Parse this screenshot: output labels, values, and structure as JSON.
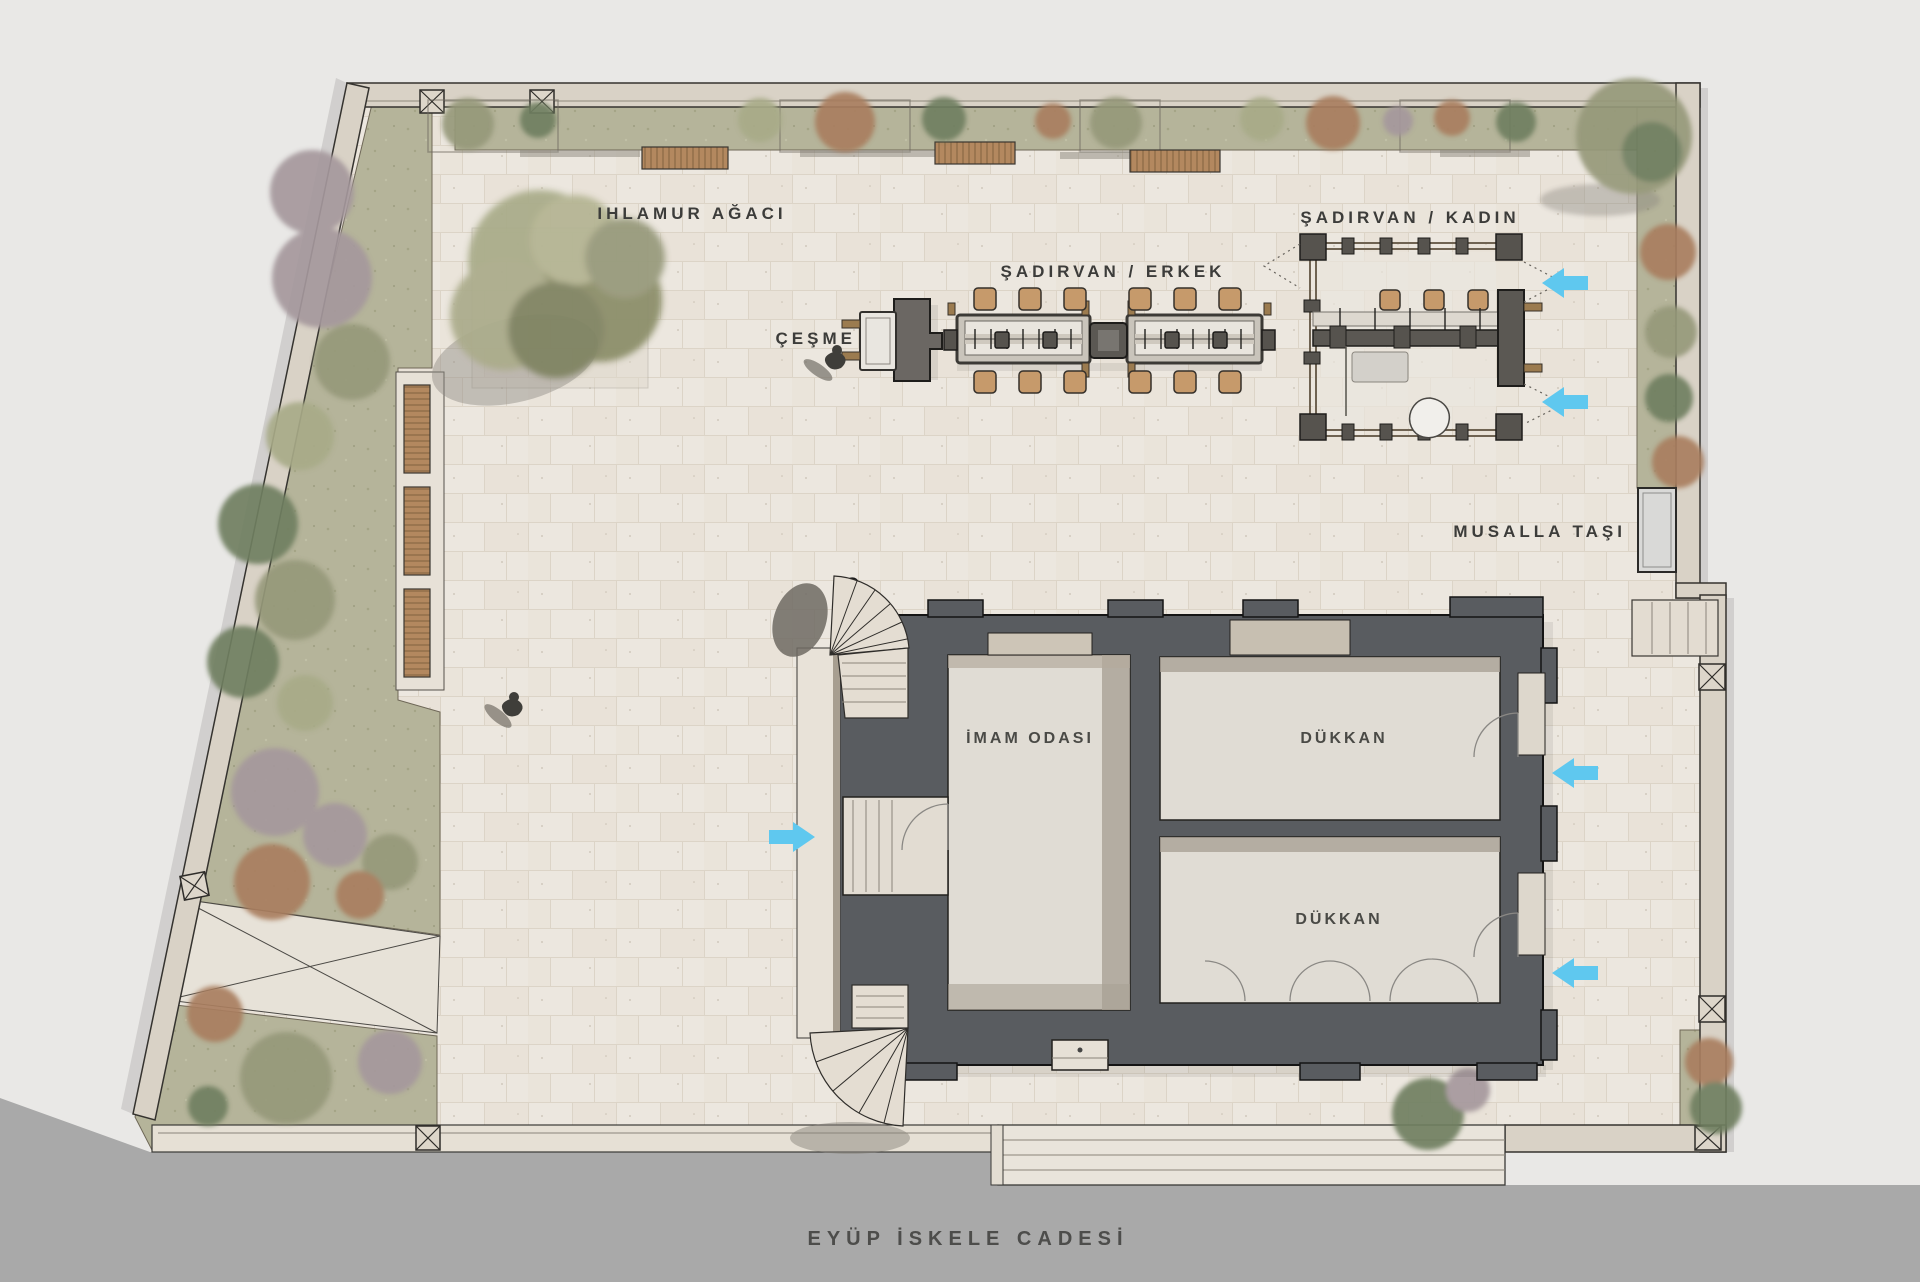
{
  "labels": {
    "linden_tree": "IHLAMUR AĞACI",
    "fountain": "ÇEŞME",
    "sadirvan_men": "ŞADIRVAN / ERKEK",
    "sadirvan_women": "ŞADIRVAN / KADIN",
    "musalla_stone": "MUSALLA TAŞI",
    "imam_room": "İMAM ODASI",
    "shop_upper": "DÜKKAN",
    "shop_lower": "DÜKKAN",
    "street": "EYÜP İSKELE CADESİ"
  },
  "palette": {
    "background": "#e9e8e6",
    "street": "#a9a9a9",
    "street_text": "#4d4d4b",
    "paving": "#ece7df",
    "paving_line": "#dcd4c7",
    "wall_band": "#d9d2c6",
    "garden": "#b5b49a",
    "building_wall": "#595c60",
    "room_floor": "#e0dcd4",
    "room_shadow": "#a9a195",
    "stool_wood": "#c69a6b",
    "bench_wood": "#b3885f",
    "arrow_blue": "#5fc8ef",
    "label_text": "#3c3c3a",
    "tree_sage": "#96997a",
    "tree_olive": "#a8ab88",
    "tree_green": "#6f7f60",
    "tree_rust": "#a97e5e",
    "tree_mauve": "#a5989c"
  },
  "annotations": {
    "entrance_arrows": [
      {
        "at": "sadirvan-women-upper-gate",
        "direction": "left"
      },
      {
        "at": "sadirvan-women-lower-gate",
        "direction": "left"
      },
      {
        "at": "building-west-entrance",
        "direction": "right"
      },
      {
        "at": "shop-upper-entrance",
        "direction": "left"
      },
      {
        "at": "shop-lower-entrance",
        "direction": "left"
      }
    ]
  }
}
